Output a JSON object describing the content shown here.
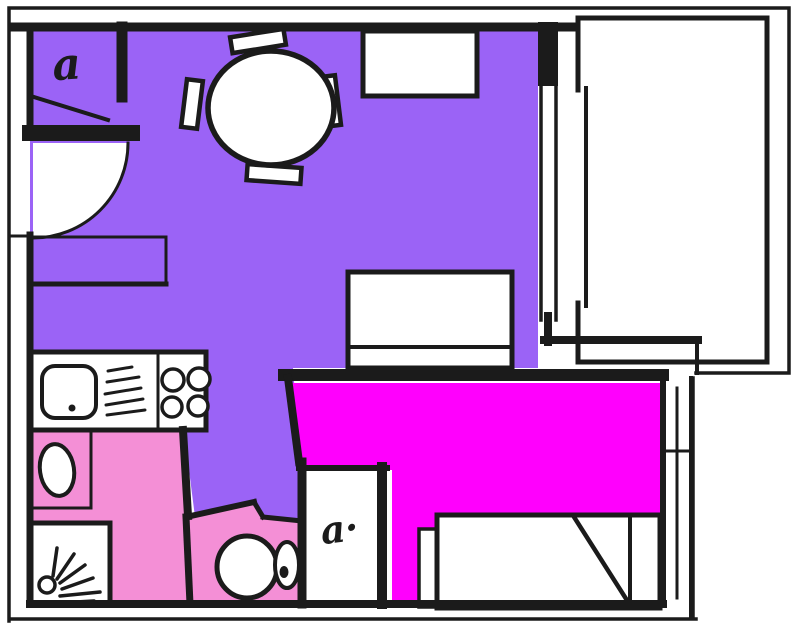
{
  "plan": {
    "annotations": {
      "entry_coat_hook_glyph": "a",
      "wardrobe_coat_hook_glyph": "a·"
    }
  },
  "palette": {
    "paper": "#ffffff",
    "wall_ink": "#1b1b1b",
    "living_dining_fill": "#9b63f6",
    "bathroom_wc_fill": "#f48fd6",
    "bedroom_fill": "#ff00fd"
  }
}
